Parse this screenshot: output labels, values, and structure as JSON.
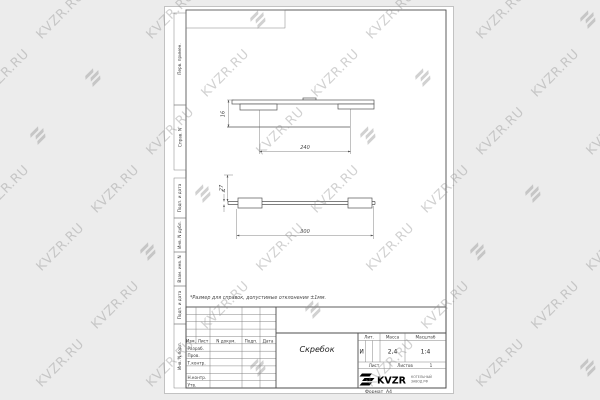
{
  "watermark": {
    "text": "KVZR.RU",
    "color": "#8e8e8e"
  },
  "sheet": {
    "note": "*Размер для справок, допустимые отклонения ±1мм.",
    "format_label": "Формат",
    "format_value": "А4",
    "margin_boxes": [
      {
        "label": "Перв. примен."
      },
      {
        "label": "Справ. N"
      },
      {
        "label": "Подп. и дата"
      },
      {
        "label": "Инв. N дубл."
      },
      {
        "label": "Взам. инв. N"
      },
      {
        "label": "Подп. и дата"
      },
      {
        "label": "Инв. N подл."
      }
    ]
  },
  "drawing": {
    "dims": {
      "front_height": "16",
      "front_width": "240",
      "side_height": "27",
      "side_thickness": "4",
      "side_length": "300"
    }
  },
  "title_block": {
    "header_cols": [
      "Изм.",
      "Лист",
      "N докум.",
      "Подп.",
      "Дата"
    ],
    "row_labels": [
      "Разраб.",
      "Пров.",
      "Т.контр.",
      "Н.контр.",
      "Утв."
    ],
    "part_name": "Скребок",
    "lit_label": "Лит.",
    "lit_value": "И",
    "mass_label": "Масса",
    "mass_value": "2,4",
    "scale_label": "Масштаб",
    "scale_value": "1:4",
    "sheet_label": "Лист",
    "sheets_label": "Листов",
    "sheets_value": "1",
    "company_logo": "KVZR",
    "company_line1": "КОТЕЛЬНЫЙ",
    "company_line2": "ЗАВОД РФ"
  }
}
